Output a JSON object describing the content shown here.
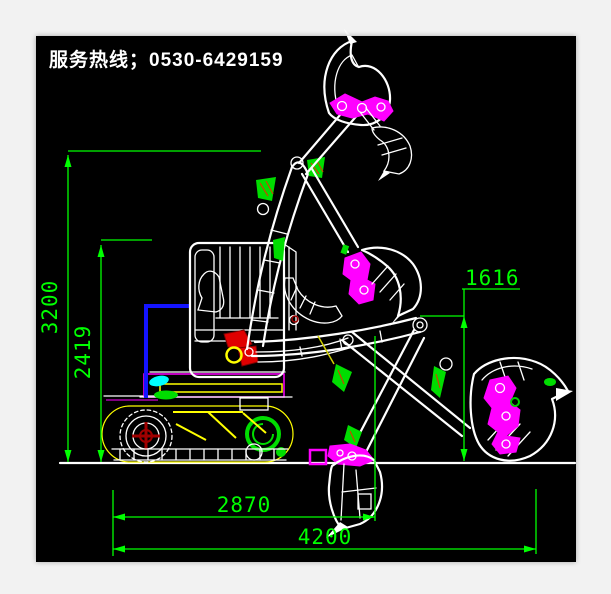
{
  "header": {
    "hotline_text": "服务热线；0530-6429159"
  },
  "canvas": {
    "background": "#000000",
    "frame_background": "#f2f2f2"
  },
  "dimensions": {
    "v3200": {
      "value": "3200",
      "orientation": "vertical"
    },
    "v2419": {
      "value": "2419",
      "orientation": "vertical"
    },
    "v1616": {
      "value": "1616",
      "orientation": "vertical"
    },
    "h2870": {
      "value": "2870",
      "orientation": "horizontal"
    },
    "h4200": {
      "value": "4200",
      "orientation": "horizontal"
    }
  },
  "colors": {
    "dimension_green": "#00ff00",
    "outline_white": "#ffffff",
    "linkage_magenta": "#ff00ff",
    "highlight_green": "#00dd00",
    "hatch_red": "#c84600",
    "boom_foot_red": "#e00000",
    "hub_dark_red": "#a00000",
    "cylinder_yellow": "#ffff00",
    "track_oval_yellow": "#c8c84e",
    "handrail_blue": "#1414ff",
    "bracket_cyan": "#00ffff"
  }
}
